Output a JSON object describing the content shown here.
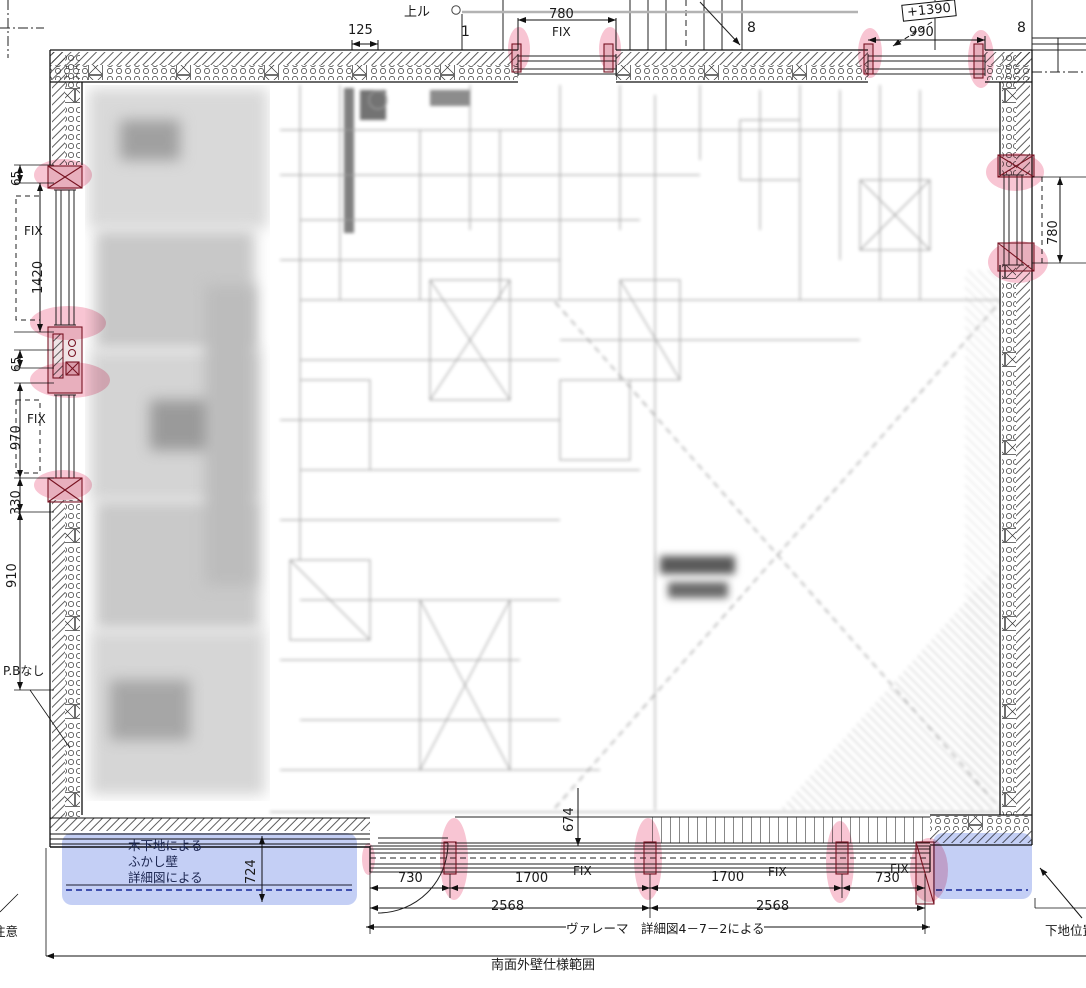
{
  "drawing": {
    "type": "architectural-floor-plan",
    "fix_label": "FIX",
    "top": {
      "up_label": "上ル",
      "dim_125": "125",
      "grid_left": "1",
      "dim_780": "780",
      "grid_mid": "8",
      "level": "+1390",
      "dim_990": "990",
      "grid_right": "8"
    },
    "left": {
      "dim_65_upper": "65",
      "dim_1420": "1420",
      "dim_65_lower": "65",
      "dim_970": "970",
      "dim_330": "330",
      "dim_910": "910",
      "pb_note": "P.Bなし"
    },
    "right": {
      "dim_780": "780"
    },
    "bottom": {
      "furring_note_1": "木下地による",
      "furring_note_2": "ふかし壁",
      "furring_note_3": "詳細図による",
      "dim_724": "724",
      "dim_674": "674",
      "dim_730_left": "730",
      "dim_1700_left": "1700",
      "dim_1700_right": "1700",
      "dim_730_right": "730",
      "dim_2568_left": "2568",
      "dim_2568_right": "2568",
      "valerma_note": "ヴァレーマ　詳細図4－7－2による",
      "south_note": "南面外壁仕様範囲",
      "caution": "注意",
      "substrate_note": "下地位置"
    },
    "colors": {
      "highlight_pink": "#ee6e91",
      "highlight_blue": "#7389e6",
      "detail_red": "#7b1828",
      "navy_dash": "#1b2f9e",
      "rail_gray": "#b3b3b3"
    }
  }
}
